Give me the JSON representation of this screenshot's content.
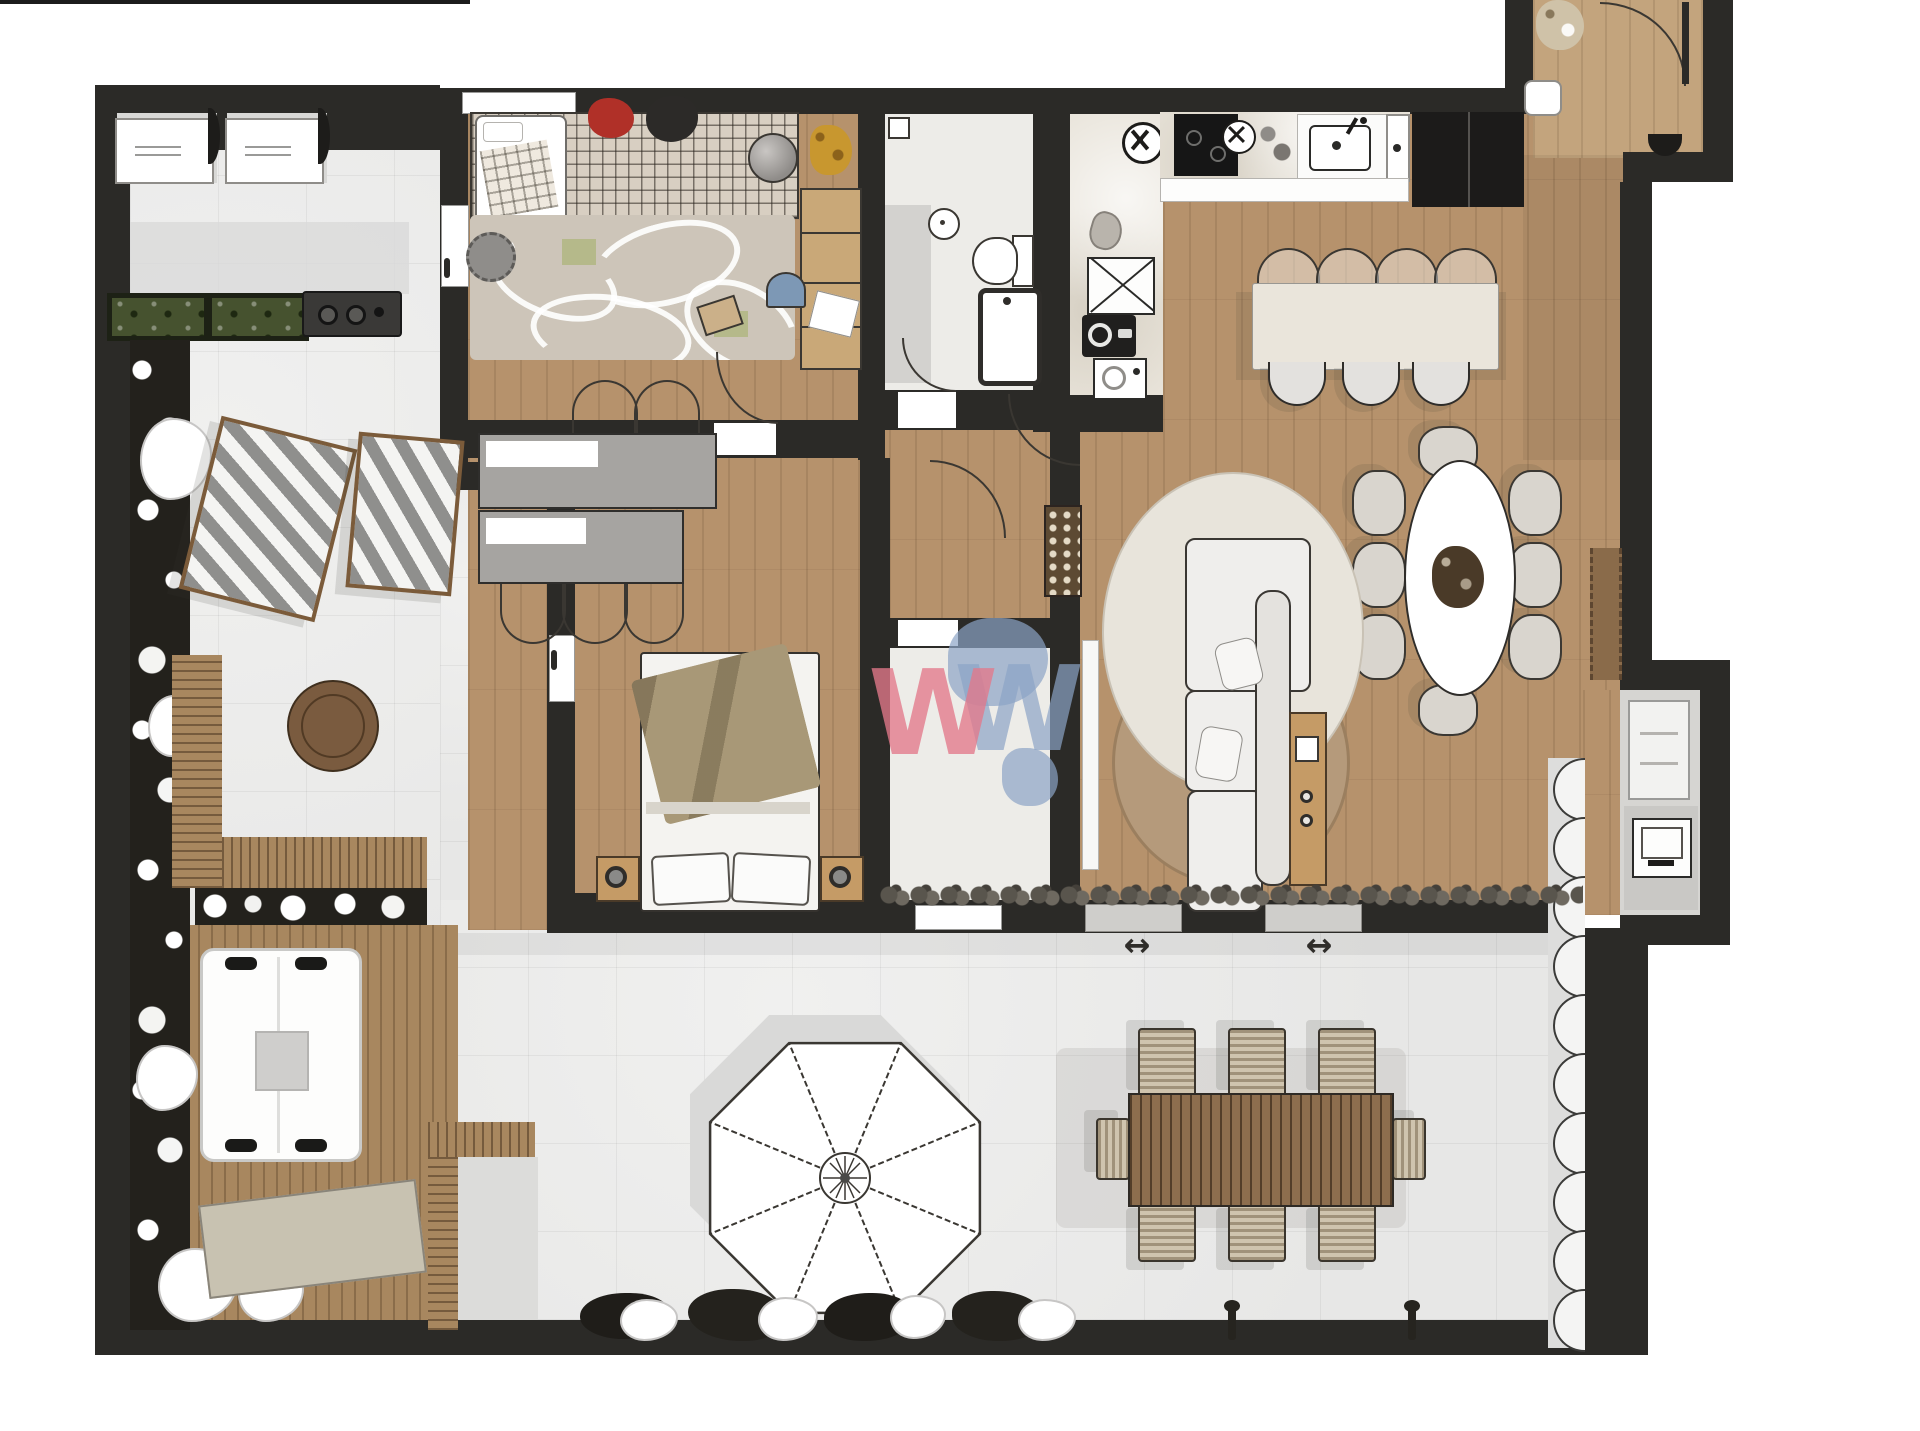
{
  "palette": {
    "wall": "#2b2a27",
    "line": "#3a3732",
    "wood": "#b6926c",
    "entry_wood": "#c3a47d",
    "tile": "#e9e9e8",
    "deck": "#a8875f",
    "marble": "#e8e3d9",
    "bath_floor": "#edece8",
    "grey_floor": "#d6d5d2",
    "soft_grey": "#d9d9d7",
    "furn_grey": "#a6a4a1",
    "rug_cream": "#e8e4db",
    "rug_brown": "#b59a7b",
    "rug_nursery": "#cdc5b9",
    "crib_grid": "#d8cfc2",
    "hedge": "#46522f",
    "plant_dark": "#23211c",
    "island_marble": "#eae5db",
    "sofa_white": "#efeeec",
    "bed_white": "#f4f3f0",
    "blanket": "#a89877",
    "wood_furn": "#c59b66",
    "table_brown": "#7a5b3f",
    "stove_black": "#161616",
    "washer_black": "#201f1e",
    "pebble": "#59554d",
    "outdoor_chair": "#cfc4ae",
    "mat": "#c8c2b1",
    "red_toy": "#b03028",
    "giraffe": "#c8972f",
    "watermark_pink": "rgba(227,121,138,0.78)",
    "watermark_blue": "rgba(140,164,198,0.70)"
  },
  "watermark": {
    "letter": "W"
  },
  "markers": {
    "slide_arrow": "↔"
  }
}
